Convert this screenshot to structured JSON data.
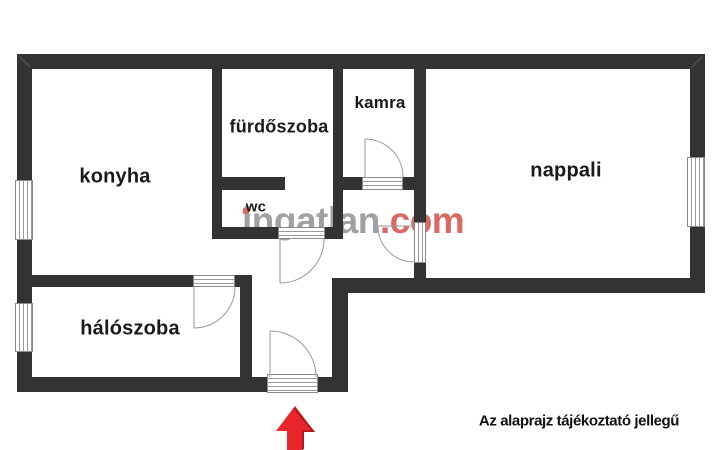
{
  "floorplan": {
    "rooms": {
      "konyha": {
        "label": "konyha"
      },
      "furdoszoba": {
        "label": "fürdőszoba"
      },
      "wc": {
        "label": "wc"
      },
      "kamra": {
        "label": "kamra"
      },
      "nappali": {
        "label": "nappali"
      },
      "haloszoba": {
        "label": "hálószoba"
      }
    },
    "watermark": {
      "part_i": "i",
      "part_rest": "ngatlan",
      "part_tld": ".com"
    },
    "note": "Az alaprajz tájékoztató jellegű",
    "colors": {
      "wall": "#333333",
      "floor": "#ffffff",
      "arrow_red": "#e8262b",
      "arrow_red_dark": "#b01b1f",
      "watermark_gray": "#9d9d9d",
      "watermark_red": "#d9605c",
      "door_line": "#9a9a9a"
    }
  }
}
